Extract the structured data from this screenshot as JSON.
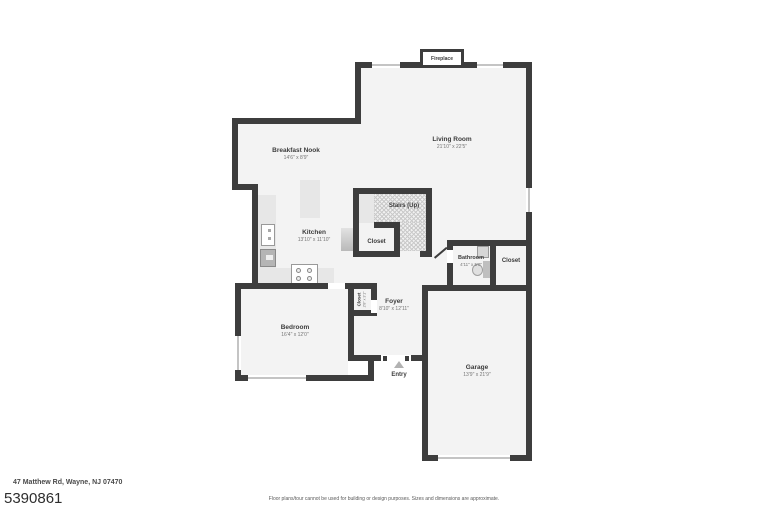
{
  "colors": {
    "wall": "#3d3d3d",
    "floor": "#f3f3f3",
    "counter": "#e7e7e7",
    "hatch_line": "#c9c9c9",
    "window_line": "#c4c4c4",
    "fixture": "#b5b5b5",
    "text_primary": "#3c3c3c",
    "text_secondary": "#757575"
  },
  "floorplan": {
    "fireplace": {
      "label": "Fireplace"
    },
    "entry": {
      "label": "Entry"
    },
    "rooms": {
      "living_room": {
        "name": "Living Room",
        "dims": "21'10\" x 22'5\""
      },
      "breakfast_nook": {
        "name": "Breakfast Nook",
        "dims": "14'6\" x 8'9\""
      },
      "kitchen": {
        "name": "Kitchen",
        "dims": "13'10\" x 11'10\""
      },
      "stairs": {
        "name": "Stairs (Up)"
      },
      "stairs_closet": {
        "name": "Closet"
      },
      "bathroom": {
        "name": "Bathroom",
        "dims": "4'11\" x 5'0\""
      },
      "hall_closet": {
        "name": "Closet"
      },
      "foyer": {
        "name": "Foyer",
        "dims": "8'10\" x 12'11\""
      },
      "foyer_closet": {
        "name": "Closet",
        "dims": "2'8\" x 3'1\""
      },
      "bedroom": {
        "name": "Bedroom",
        "dims": "16'4\" x 12'0\""
      },
      "garage": {
        "name": "Garage",
        "dims": "13'9\" x 21'9\""
      }
    }
  },
  "footer": {
    "address": "47 Matthew Rd, Wayne, NJ 07470",
    "listing_id": "5390861",
    "disclaimer": "Floor plans/tour cannot be used for building or design purposes. Sizes and dimensions are approximate."
  }
}
